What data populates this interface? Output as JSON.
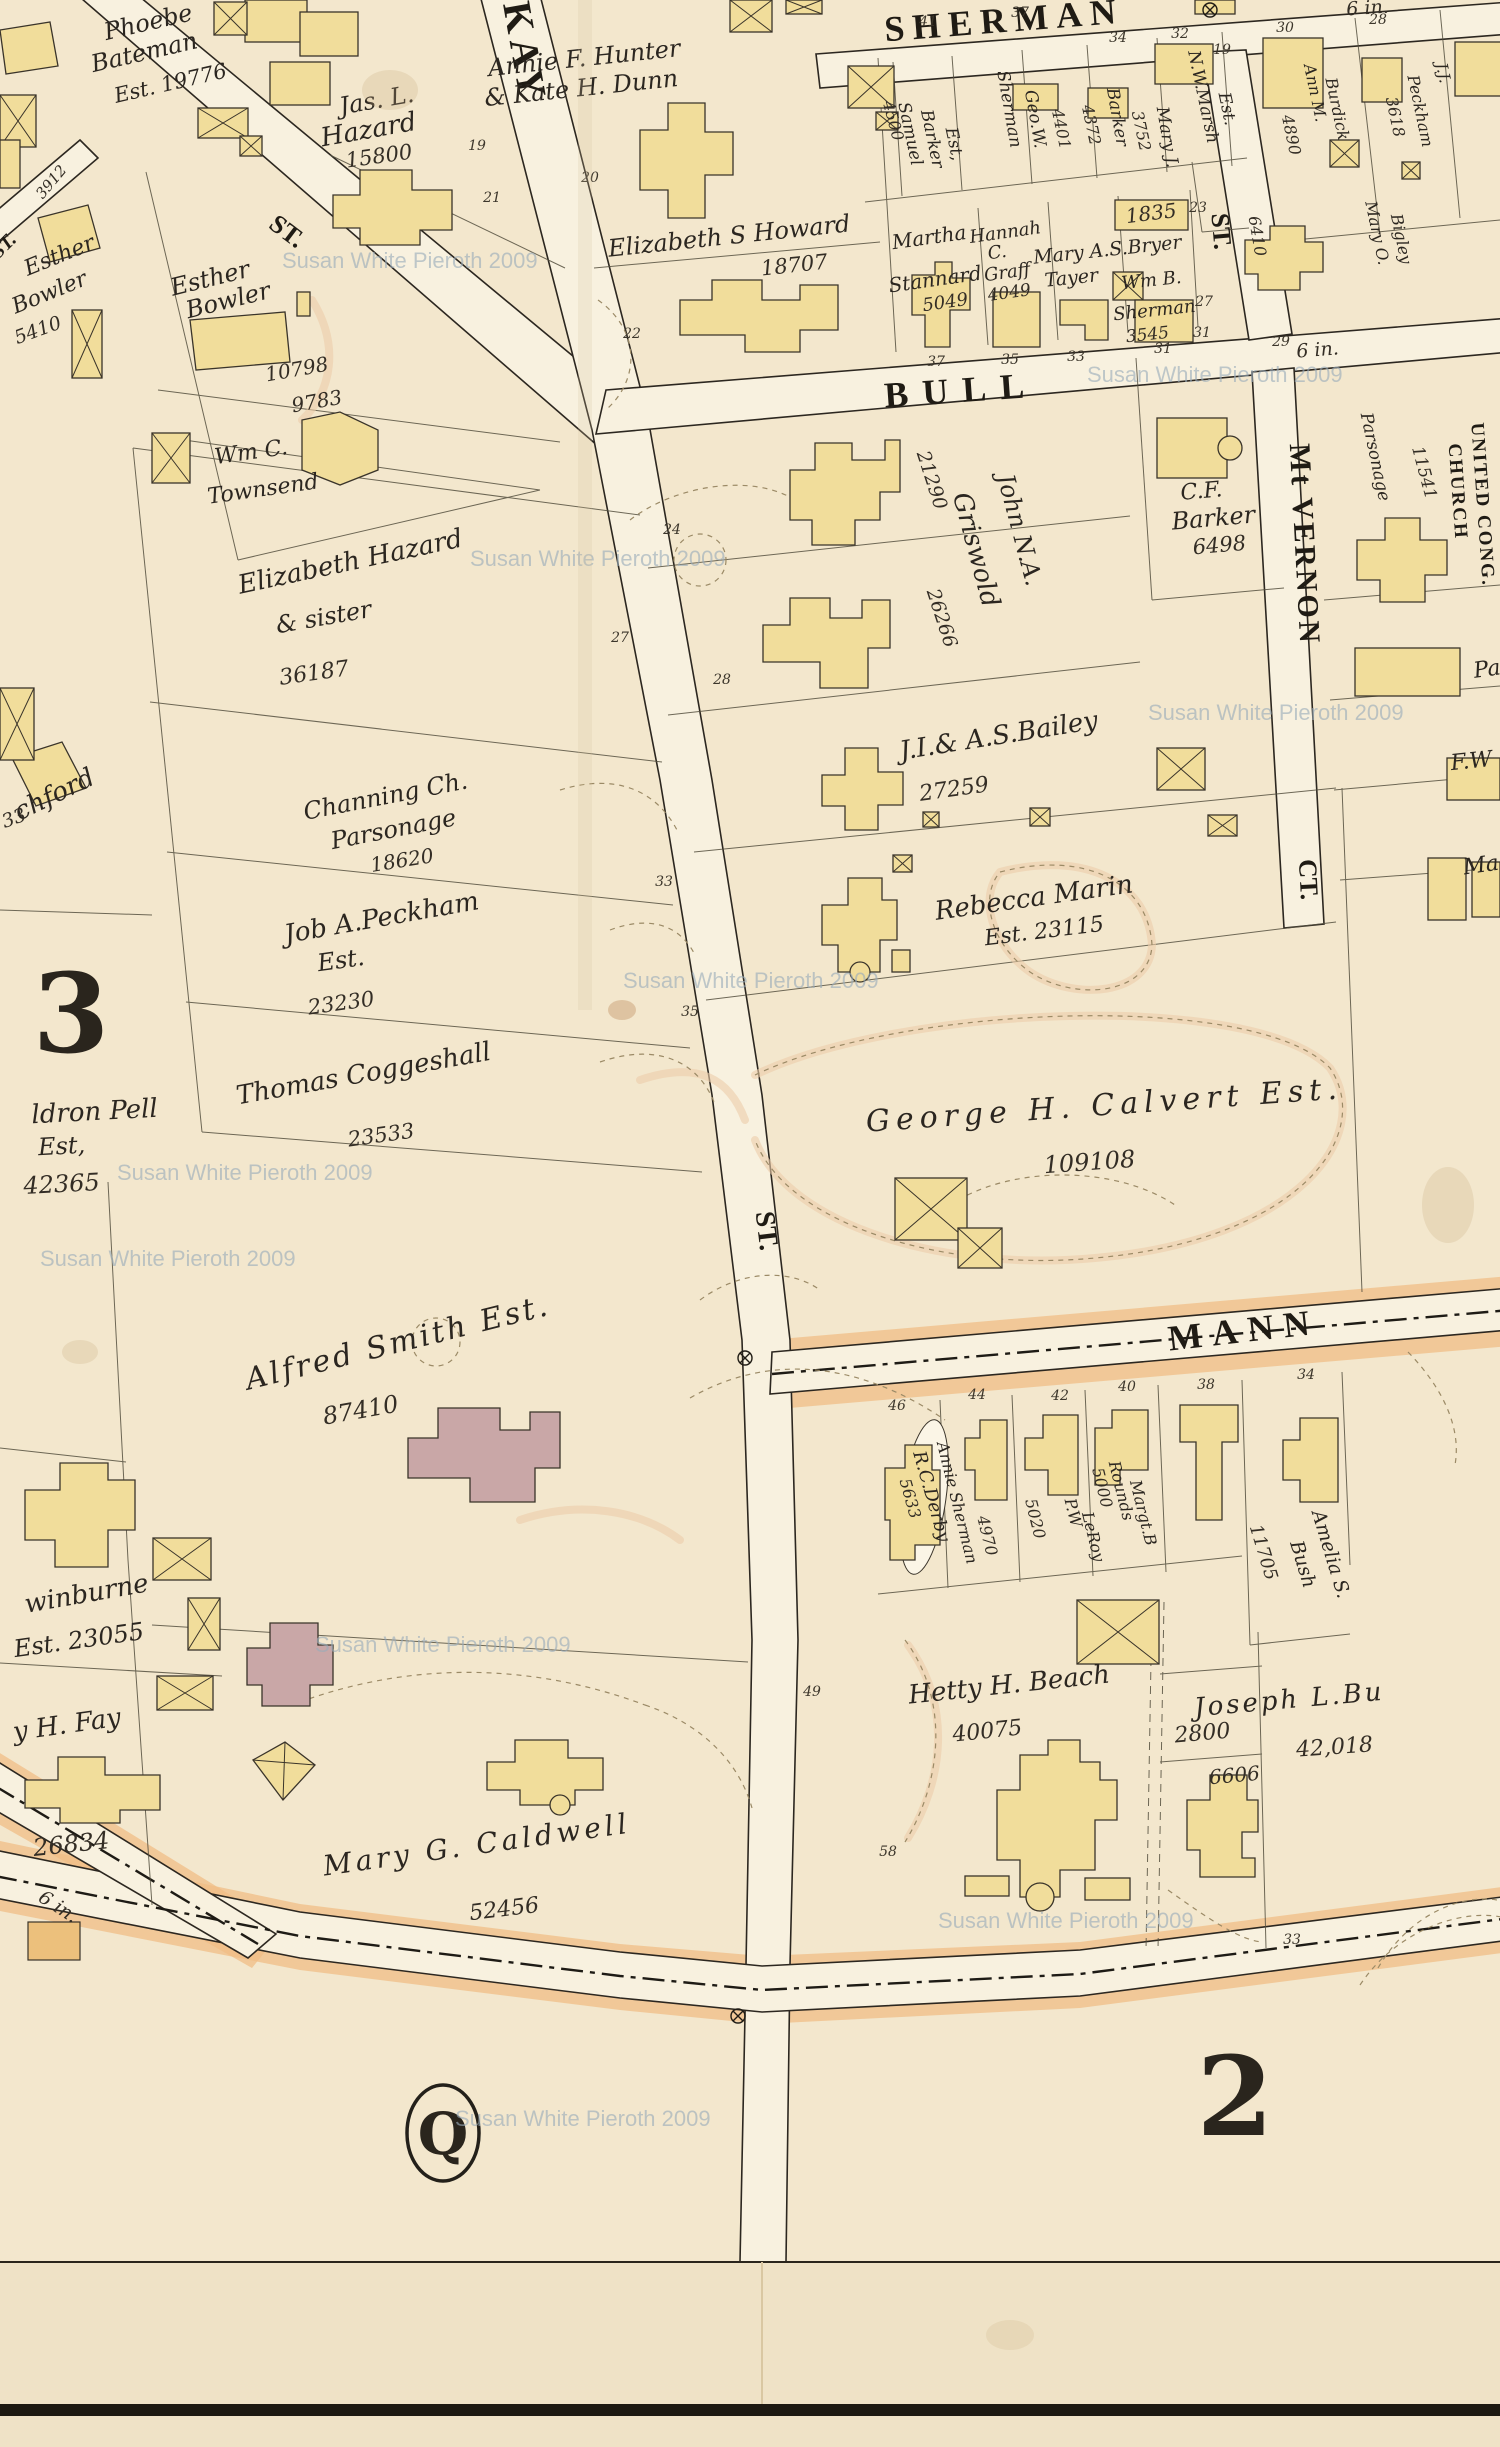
{
  "misc": {
    "watermark": "Susan White Pieroth 2009",
    "pipe_label": "6 in."
  },
  "plates": {
    "left": "3",
    "right": "2",
    "circle": "Q"
  },
  "streets": {
    "sherman": "SHERMAN",
    "bull": "BULL",
    "kay": "KAY",
    "kay_suffix": "ST.",
    "unnamed": "ST.",
    "mt_vernon_st": "ST.",
    "mt_vernon": "Mt VERNON",
    "mt_vernon_ct": "CT.",
    "mann": "MANN"
  },
  "parcels": [
    {
      "name": "phoebe-bateman",
      "lines": [
        "Phoebe",
        "Bateman",
        "Est. 19776"
      ]
    },
    {
      "name": "jas-l-hazard",
      "lines": [
        "Jas. L.",
        "Hazard",
        "15800"
      ]
    },
    {
      "name": "hunter-dunn",
      "lines": [
        "Annie F. Hunter",
        "& Kate H. Dunn"
      ]
    },
    {
      "name": "elizabeth-howard",
      "lines": [
        "Elizabeth S Howard",
        "18707"
      ]
    },
    {
      "name": "samuel-barker",
      "lines": [
        "Samuel",
        "Barker",
        "Est,",
        "4500"
      ]
    },
    {
      "name": "geo-w-sherman",
      "lines": [
        "Geo.W.",
        "Sherman",
        "4401"
      ]
    },
    {
      "name": "barker",
      "lines": [
        "Barker",
        "4372"
      ]
    },
    {
      "name": "mary-j",
      "lines": [
        "Mary J.",
        "3752"
      ]
    },
    {
      "name": "nw-marsh",
      "lines": [
        "N.W.Marsh",
        "Est."
      ]
    },
    {
      "name": "lot-1835",
      "lines": [
        "1835"
      ]
    },
    {
      "name": "ann-burdick",
      "lines": [
        "Ann M.",
        "Burdick",
        "4890"
      ]
    },
    {
      "name": "jj-peckham",
      "lines": [
        "J.J.",
        "Peckham",
        "3618"
      ]
    },
    {
      "name": "mary-bigley",
      "lines": [
        "Mary O.",
        "Bigley",
        "6410"
      ]
    },
    {
      "name": "martha-stannard",
      "lines": [
        "Martha",
        "Stannard",
        "5049"
      ]
    },
    {
      "name": "hannah-graff",
      "lines": [
        "Hannah",
        "C.",
        "Graff",
        "4049"
      ]
    },
    {
      "name": "bryer-tayer",
      "lines": [
        "Mary A.S.Bryer",
        "Tayer"
      ]
    },
    {
      "name": "wm-b-sherman",
      "lines": [
        "Wm B.",
        "Sherman",
        "3545"
      ]
    },
    {
      "name": "esther-bowler-1",
      "lines": [
        "Esther",
        "Bowler",
        "5410"
      ]
    },
    {
      "name": "esther-bowler-2",
      "lines": [
        "Esther",
        "Bowler",
        "10798",
        "9783"
      ]
    },
    {
      "name": "wm-c-townsend",
      "lines": [
        "Wm C.",
        "Townsend"
      ]
    },
    {
      "name": "john-griswold",
      "lines": [
        "John N.A.",
        "Griswold",
        "21290",
        "26266"
      ]
    },
    {
      "name": "cf-barker",
      "lines": [
        "C.F.",
        "Barker",
        "6498"
      ]
    },
    {
      "name": "parsonage",
      "lines": [
        "Parsonage",
        "11541"
      ]
    },
    {
      "name": "united-cong-church",
      "lines": [
        "UNITED CONG.",
        "CHURCH"
      ]
    },
    {
      "name": "elizabeth-hazard",
      "lines": [
        "Elizabeth Hazard",
        "& sister",
        "36187"
      ]
    },
    {
      "name": "channing-parsonage",
      "lines": [
        "Channing Ch.",
        "Parsonage",
        "18620"
      ]
    },
    {
      "name": "bailey",
      "lines": [
        "J.I.& A.S.Bailey",
        "27259"
      ]
    },
    {
      "name": "rebecca-marin",
      "lines": [
        "Rebecca Marin",
        "Est. 23115"
      ]
    },
    {
      "name": "job-peckham",
      "lines": [
        "Job A.Peckham",
        "Est.",
        "23230"
      ]
    },
    {
      "name": "thomas-coggeshall",
      "lines": [
        "Thomas Coggeshall",
        "23533"
      ]
    },
    {
      "name": "chford",
      "lines": [
        "chford",
        "33"
      ]
    },
    {
      "name": "pell",
      "lines": [
        "ldron Pell",
        "Est,",
        "42365"
      ]
    },
    {
      "name": "george-calvert",
      "lines": [
        "George H. Calvert Est.",
        "109108"
      ]
    },
    {
      "name": "alfred-smith",
      "lines": [
        "Alfred Smith Est.",
        "87410"
      ]
    },
    {
      "name": "swinburne",
      "lines": [
        "winburne",
        "Est. 23055"
      ]
    },
    {
      "name": "fay",
      "lines": [
        "y H. Fay",
        "26834"
      ]
    },
    {
      "name": "mary-caldwell",
      "lines": [
        "Mary G. Caldwell",
        "52456"
      ]
    },
    {
      "name": "rc-derby",
      "lines": [
        "R.C.Derby",
        "5633"
      ]
    },
    {
      "name": "annie-sherman",
      "lines": [
        "Annie Sherman",
        "4970"
      ]
    },
    {
      "name": "pw-leroy",
      "lines": [
        "P.W",
        "LeRoy",
        "5020"
      ]
    },
    {
      "name": "margt-rounds",
      "lines": [
        "Margt.B",
        "Rounds",
        "5000"
      ]
    },
    {
      "name": "amelia-bush",
      "lines": [
        "Amelia S.",
        "Bush",
        "11705"
      ]
    },
    {
      "name": "hetty-beach",
      "lines": [
        "Hetty H. Beach",
        "40075"
      ]
    },
    {
      "name": "joseph-bush",
      "lines": [
        "Joseph L.Bu",
        "2800",
        "42,018",
        "6606"
      ]
    },
    {
      "name": "edge-fragments",
      "lines": [
        "Pa",
        "F.W",
        "Ma"
      ]
    }
  ],
  "lots": {
    "kay": [
      "19",
      "21",
      "20",
      "22",
      "24",
      "27",
      "28",
      "33",
      "35",
      "49",
      "58"
    ],
    "sherman": [
      "41",
      "37",
      "34",
      "32",
      "19",
      "30",
      "28",
      "23"
    ],
    "bull": [
      "37",
      "35",
      "33",
      "31",
      "29",
      "27",
      "31"
    ],
    "mann": [
      "46",
      "44",
      "42",
      "40",
      "38",
      "34"
    ],
    "bottom": [
      "33"
    ]
  }
}
